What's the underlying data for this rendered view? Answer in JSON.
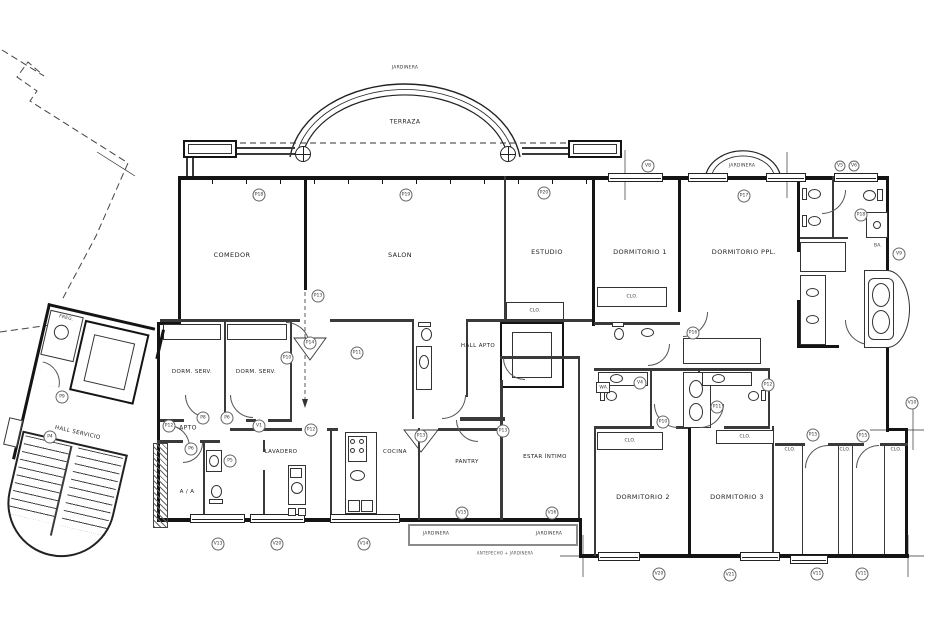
{
  "rooms": {
    "terraza": "TERRAZA",
    "comedor": "COMEDOR",
    "salon": "SALON",
    "estudio": "ESTUDIO",
    "dormitorio1": "DORMITORIO 1",
    "dormitorio_ppl": "DORMITORIO PPL.",
    "dorm_serv": "DORM. SERV.",
    "hall_apto": "HALL APTO",
    "hall_servicio": "HALL SERVICIO",
    "apto": "APTO",
    "lavadero": "LAVADERO",
    "cocina": "COCINA",
    "pantry": "PANTRY",
    "estar_intimo": "ESTAR ÍNTIMO",
    "dormitorio2": "DORMITORIO 2",
    "dormitorio3": "DORMITORIO 3",
    "aa": "A / A",
    "frega": "FREG.",
    "clo": "CLO.",
    "wa": "WA."
  },
  "annotations": {
    "jardinera": "JARDINERA",
    "antepecho_note": "ANTEPECHO + JARDINERA",
    "ba": "BA."
  },
  "markers": [
    "P18",
    "P19",
    "P20",
    "P13",
    "V8",
    "V5",
    "V6",
    "P17",
    "P18",
    "V9",
    "P16",
    "P14",
    "P10",
    "P11",
    "P12",
    "P8",
    "P6",
    "V1",
    "P12",
    "P13",
    "P13",
    "P6",
    "P5",
    "V13",
    "V20",
    "V14",
    "V15",
    "V16",
    "V4",
    "P12",
    "P11",
    "P10",
    "P15",
    "P15",
    "V20",
    "V21",
    "V11",
    "V11",
    "V10",
    "P9",
    "P4"
  ],
  "colors": {
    "line": "#141414",
    "thin_line": "#3a3a3a",
    "planter": "#8a8a8a",
    "background": "#ffffff"
  }
}
